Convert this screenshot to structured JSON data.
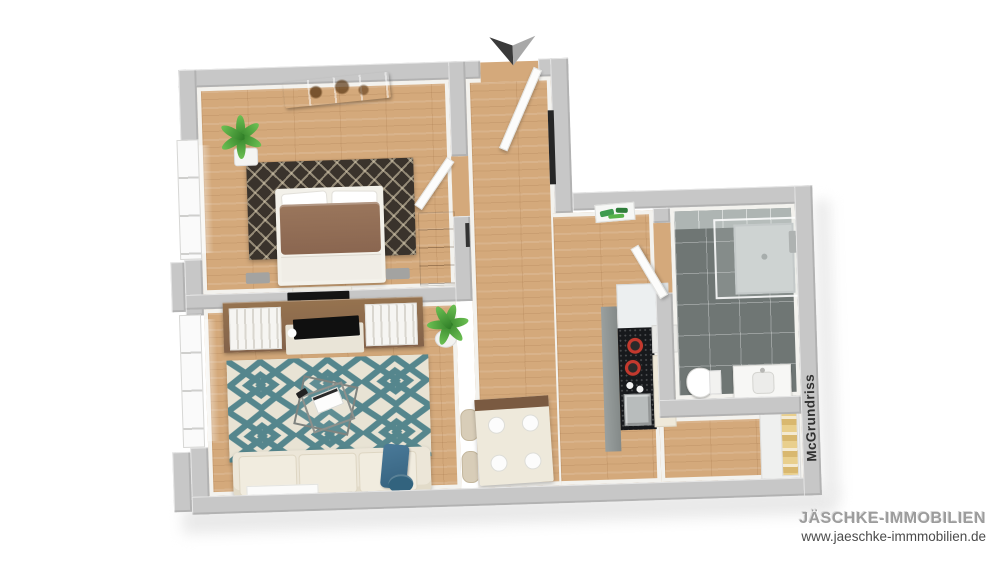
{
  "branding": {
    "company": "JÄSCHKE-IMMOBILIEN",
    "website": "www.jaeschke-immmobilien.de"
  },
  "watermark": {
    "label": "McGrundriss"
  },
  "compass": {
    "shape": "downward-arrow",
    "left_color": "#3a3a3a",
    "right_color": "#a8a8a8"
  },
  "palette": {
    "background": "#ffffff",
    "wall_top": "#c7c7c7",
    "wall_face": "#f3f2ee",
    "wood_floor": "#d4a97b",
    "bathroom_floor_tile": "#6f7674",
    "bathroom_wall_tile": "#aeb5b3",
    "bedroom_rug": "#3a332c",
    "living_rug_teal": "#55868d",
    "living_rug_cream": "#e8e3d4",
    "sofa_cream": "#ece6d8",
    "accent_blue": "#3f6f8d",
    "sideboard_brown": "#8a684a",
    "bed_duvet_brown": "#8e6b50",
    "counter_black": "#17191c",
    "burner_red": "#c3392e",
    "plant_green": "#3f9b32"
  }
}
